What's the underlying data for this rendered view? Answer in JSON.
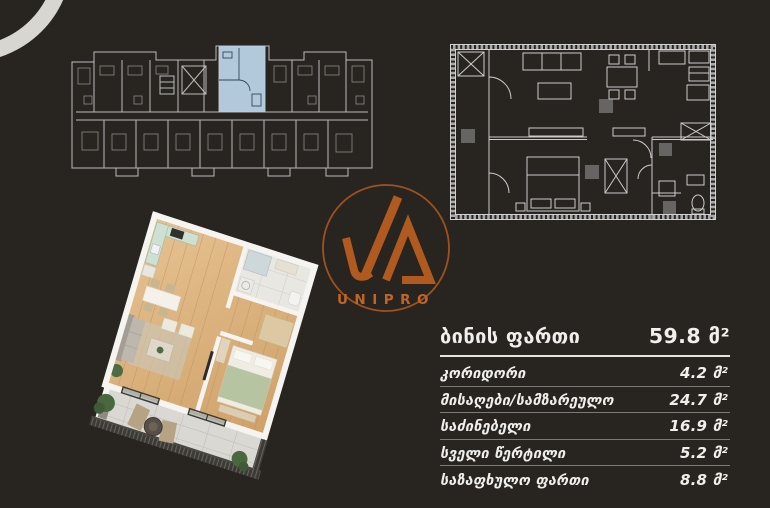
{
  "logo": {
    "text": "UNIPRO"
  },
  "area_table": {
    "header": {
      "label": "ბინის ფართი",
      "value": "59.8 მ²"
    },
    "rows": [
      {
        "label": "კორიდორი",
        "value": "4.2 მ²"
      },
      {
        "label": "მისაღები/სამზარეულო",
        "value": "24.7 მ²"
      },
      {
        "label": "საძინებელი",
        "value": "16.9 მ²"
      },
      {
        "label": "სველი წერტილი",
        "value": "5.2 მ²"
      },
      {
        "label": "საზაფხულო ფართი",
        "value": "8.8 მ²"
      }
    ]
  },
  "figures": {
    "building_floorplan": "building-level-floorplan-with-highlighted-unit",
    "apartment_floorplan": "apartment-2d-floorplan",
    "apartment_render": "apartment-3d-isometric-render"
  },
  "colors": {
    "background": "#282521",
    "accent_orange": "#b4571f",
    "logo_text_orange": "#c06a28",
    "highlight_blue": "#b8d0e4",
    "arc_white": "#d8d6d0",
    "table_text": "#f0efec"
  }
}
